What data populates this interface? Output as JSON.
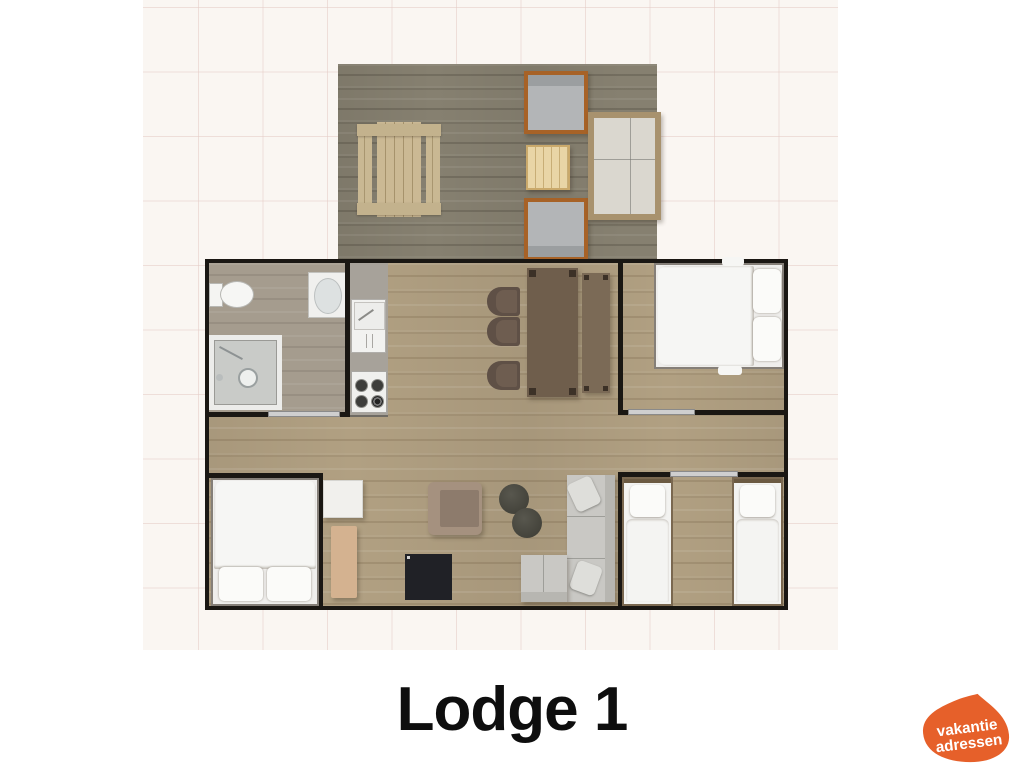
{
  "title": "Lodge 1",
  "logo": {
    "line1": "vakantie",
    "line2": "adressen"
  },
  "colors": {
    "logo_orange": "#e6602a",
    "logo_text": "#ffffff",
    "title_text": "#0e0e0e",
    "wall_black": "#1a1713",
    "floor_living_wood": "#b1a082",
    "floor_deck_wood": "#868070",
    "floor_bathroom_wood": "#a59c8e",
    "kitchen_counter_gray": "#a7a29a",
    "door_threshold_gray": "#cfcfcf",
    "page_background": "#ffffff",
    "grid_tile": "#faf6f2"
  }
}
